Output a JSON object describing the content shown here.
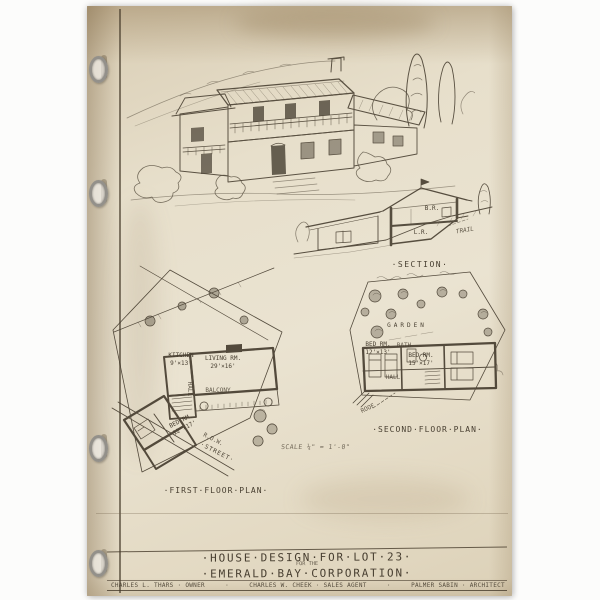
{
  "sheet": {
    "labels": {
      "section": "·SECTION·",
      "second_floor": "·SECOND·FLOOR·PLAN·",
      "first_floor": "·FIRST·FLOOR·PLAN·",
      "scale": "SCALE ¼\" = 1'-0\""
    },
    "section_drawing": {
      "upper_room": "B.R.",
      "lower_room": "L.R.",
      "site_note": "TRAIL"
    },
    "first_floor_plan": {
      "kitchen": "KITCHEN\n9'×13'",
      "living": "LIVING RM.\n29'×16'",
      "balcony": "BALCONY",
      "bedroom": "BED RM.\n12'×17'",
      "hall": "HALL",
      "right_of_way": "R.O.W.",
      "street": "·STREET·"
    },
    "second_floor_plan": {
      "garden": "GARDEN",
      "bedroom1": "BED RM.\n12'×13'",
      "bath": "BATH",
      "bedroom2": "BED RM.\n15'×17'",
      "hall": "HALL",
      "roof": "ROOF"
    },
    "title_block": {
      "line1": "·HOUSE·DESIGN·FOR·LOT·23·",
      "for_the": "FOR THE",
      "line2": "·EMERALD·BAY·CORPORATION·",
      "credits": {
        "owner": "CHARLES L. THARS · OWNER",
        "agent": "CHARLES W. CHEEK · SALES AGENT",
        "architect": "PALMER SABIN · ARCHITECT",
        "separator": "·"
      }
    },
    "colors": {
      "paper": "#e7dfcb",
      "ink": "#473e30",
      "background": "#fcfcfb"
    }
  }
}
